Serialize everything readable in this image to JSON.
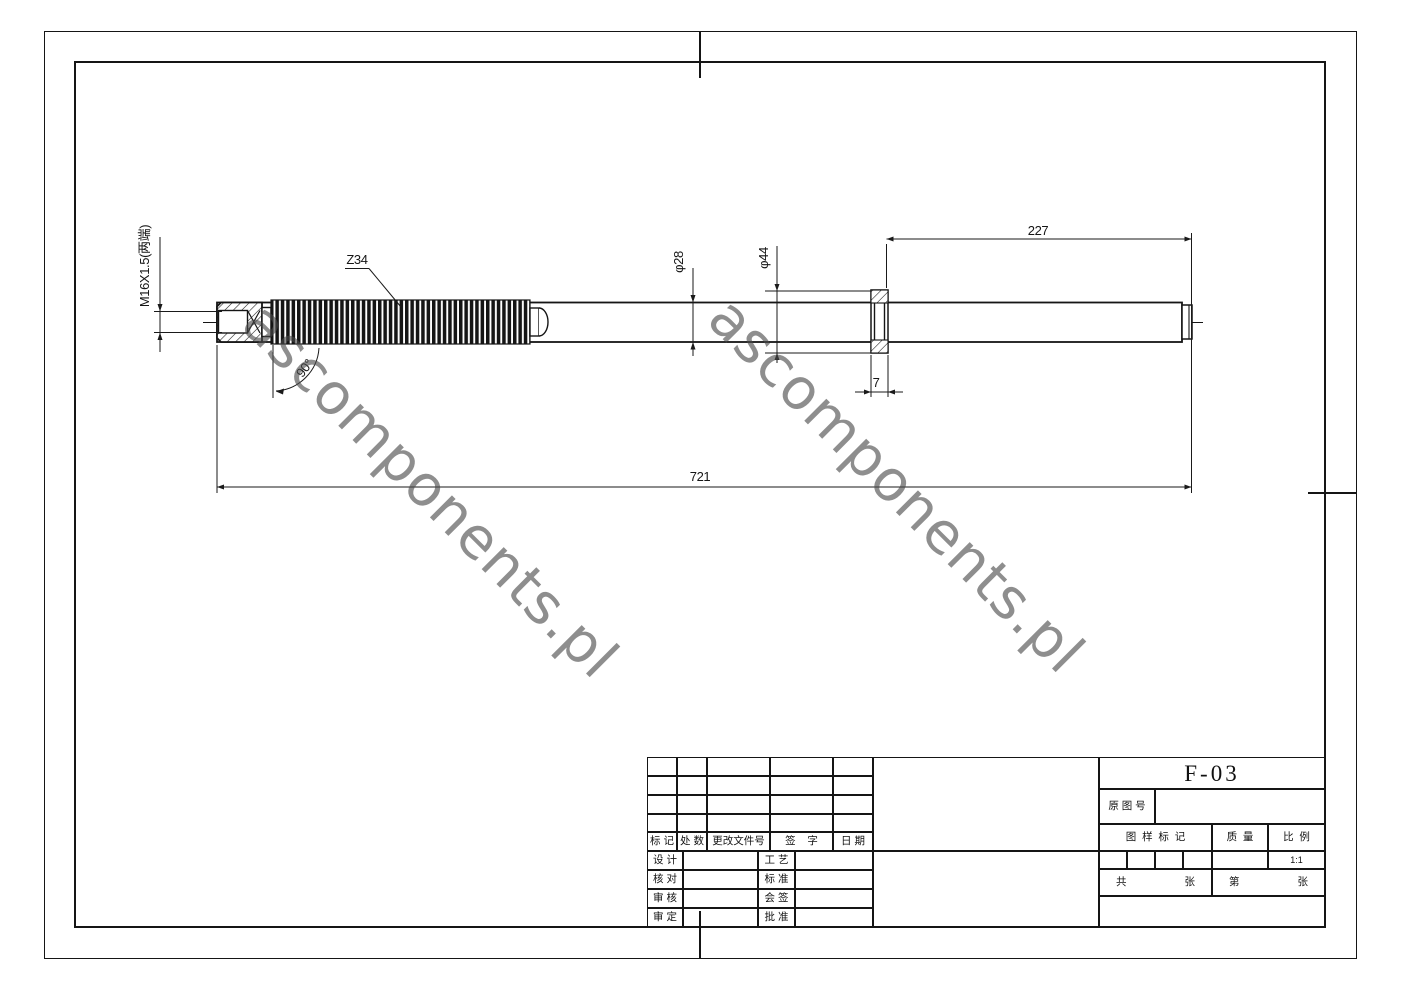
{
  "page": {
    "background": "#ffffff",
    "line_color": "#151515"
  },
  "watermark": {
    "text": "ascomponents.pl",
    "color": "#7b7b7b"
  },
  "drawing": {
    "thread_spec": "M16X1.5(两端)",
    "tooth_count": "Z34",
    "profile_angle": "90°",
    "shaft_diameter": "φ28",
    "collar_diameter": "φ44",
    "right_section_length": "227",
    "collar_width": "7",
    "total_length": "721"
  },
  "title_block": {
    "part_number": "F-03",
    "original_no_label": "原 图 号",
    "pattern_mark_label": "图  样  标  记",
    "mass_label": "质  量",
    "scale_label": "比  例",
    "scale_value": "1:1",
    "total_label": "共",
    "total_sheet": "张",
    "page_label": "第",
    "page_sheet": "张",
    "revision_headers": [
      "标 记",
      "处 数",
      "更改文件号",
      "签    字",
      "日 期"
    ],
    "sign_left": [
      "设 计",
      "核 对",
      "审 核",
      "审 定"
    ],
    "sign_right": [
      "工 艺",
      "标 准",
      "会 签",
      "批 准"
    ]
  }
}
